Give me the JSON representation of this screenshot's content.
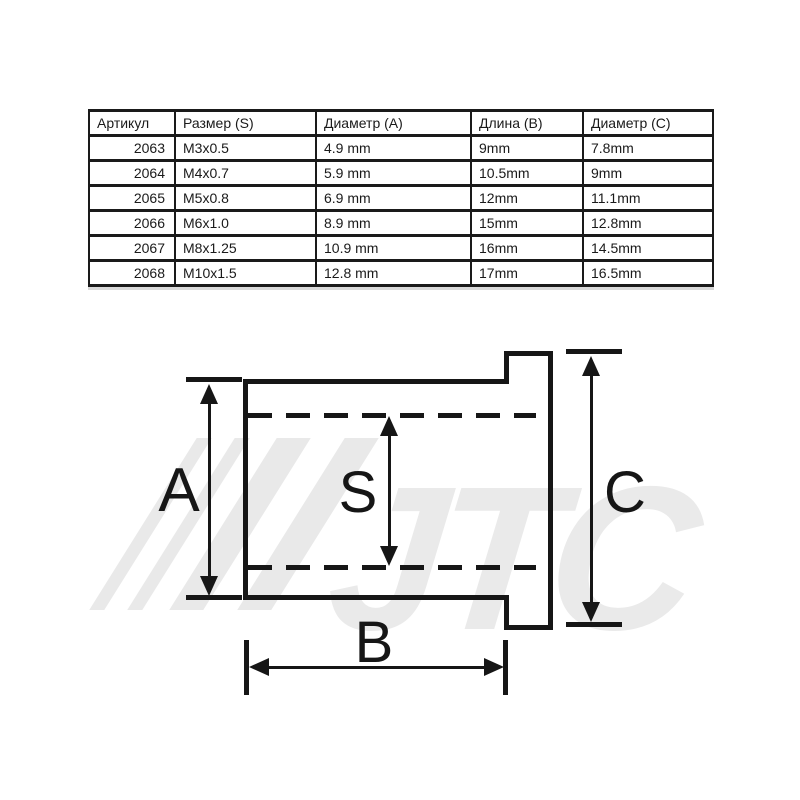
{
  "colors": {
    "background": "#ffffff",
    "ink": "#1a1a1a",
    "watermark": "#e9e9e9"
  },
  "table": {
    "headers": [
      "Артикул",
      "Размер (S)",
      "Диаметр (A)",
      "Длина (B)",
      "Диаметр (C)"
    ],
    "rows": [
      [
        "2063",
        "M3x0.5",
        "4.9 mm",
        "9mm",
        "7.8mm"
      ],
      [
        "2064",
        "M4x0.7",
        "5.9 mm",
        "10.5mm",
        "9mm"
      ],
      [
        "2065",
        "M5x0.8",
        "6.9 mm",
        "12mm",
        "11.1mm"
      ],
      [
        "2066",
        "M6x1.0",
        "8.9 mm",
        "15mm",
        "12.8mm"
      ],
      [
        "2067",
        "M8x1.25",
        "10.9 mm",
        "16mm",
        "14.5mm"
      ],
      [
        "2068",
        "M10x1.5",
        "12.8 mm",
        "17mm",
        "16.5mm"
      ]
    ]
  },
  "diagram": {
    "labels": {
      "a": "A",
      "s": "S",
      "b": "B",
      "c": "C"
    },
    "watermark_text": "JTC"
  }
}
